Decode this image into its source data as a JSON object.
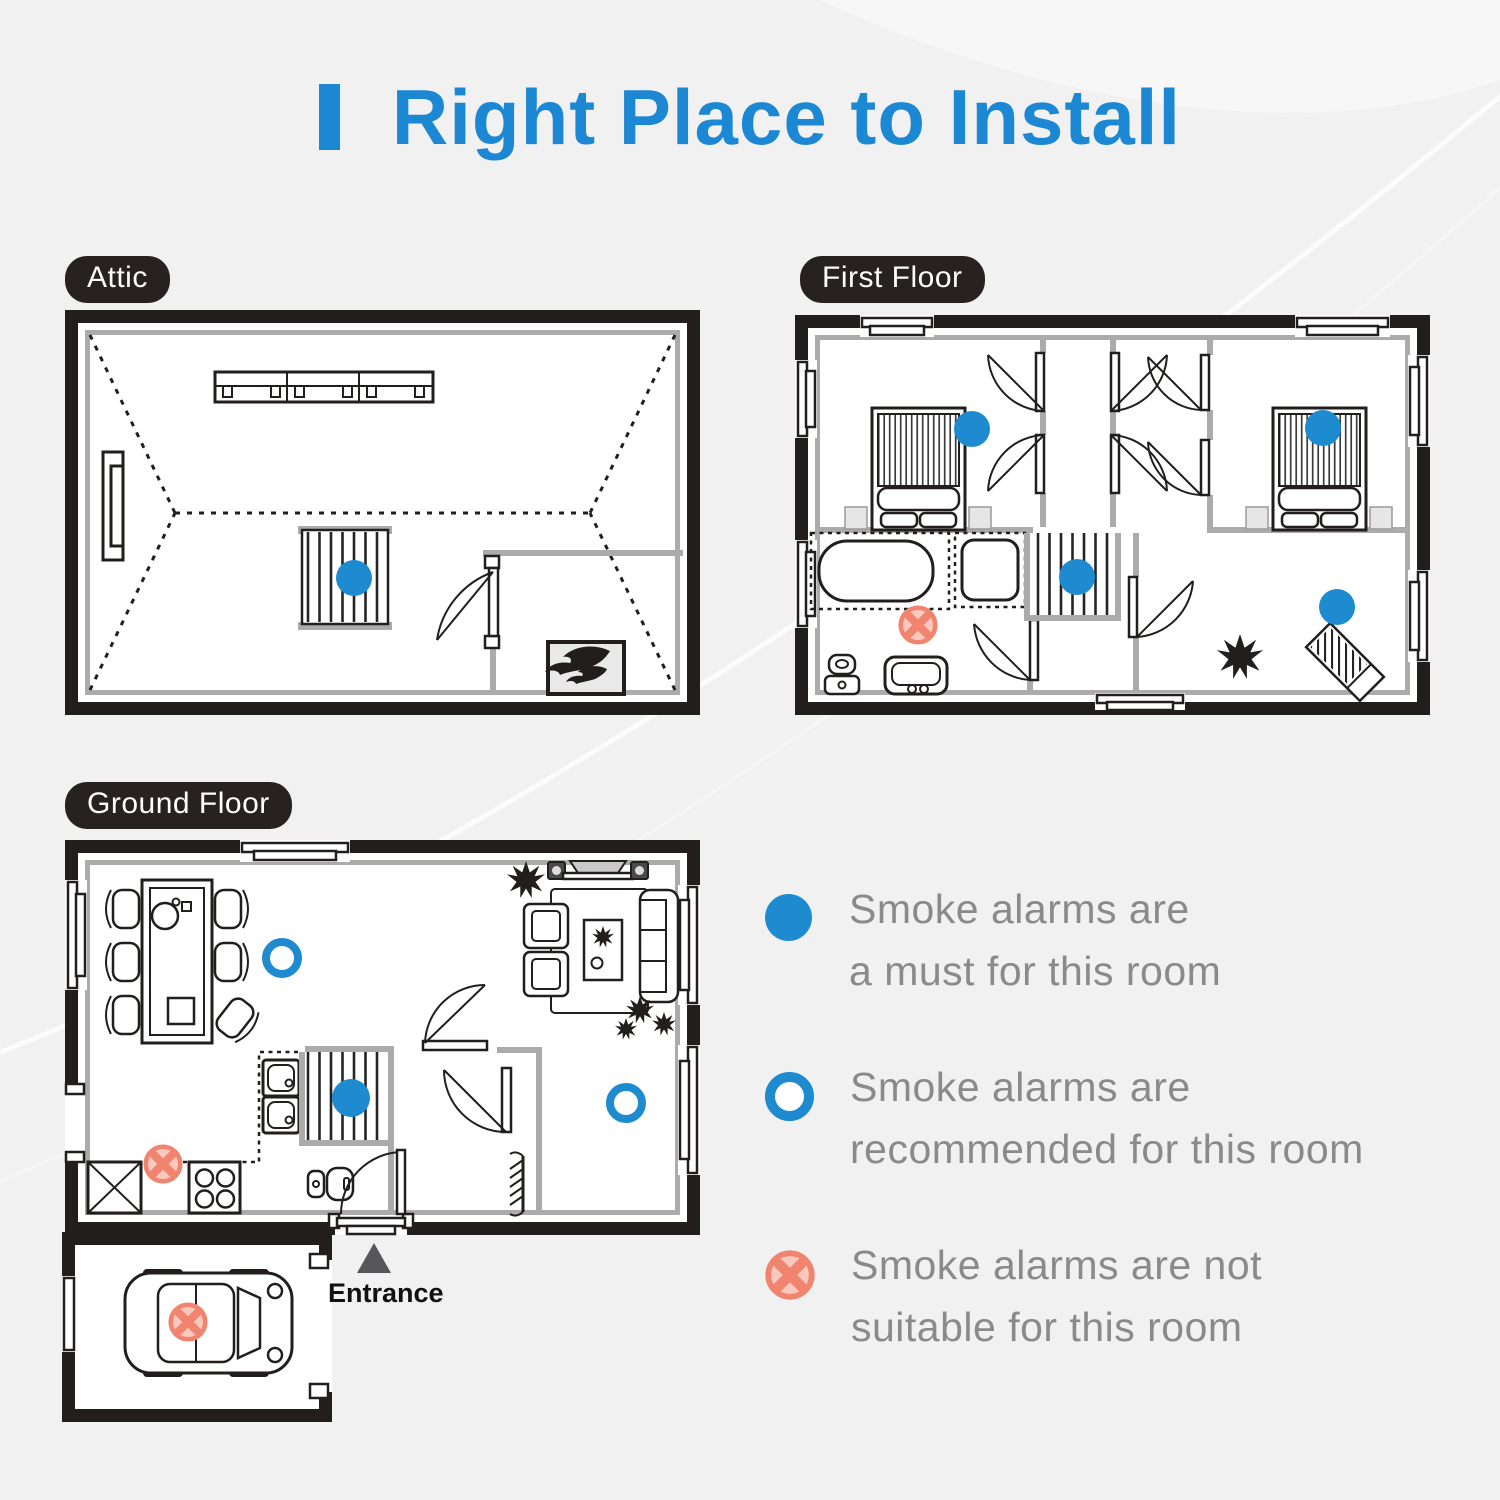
{
  "title": {
    "text": "Right Place to Install"
  },
  "floors": {
    "attic": {
      "label": "Attic"
    },
    "first": {
      "label": "First Floor"
    },
    "ground": {
      "label": "Ground Floor"
    }
  },
  "entrance_label": "Entrance",
  "legend": {
    "items": [
      {
        "type": "must",
        "lines": [
          "Smoke alarms are",
          "a must for this room"
        ]
      },
      {
        "type": "recommended",
        "lines": [
          "Smoke alarms are",
          "recommended for this room"
        ]
      },
      {
        "type": "not-suitable",
        "lines": [
          "Smoke alarms are not",
          "suitable for this room"
        ]
      }
    ]
  },
  "markers": [
    {
      "floor": "Attic",
      "type": "must",
      "location": "stairs"
    },
    {
      "floor": "First Floor",
      "type": "must",
      "location": "bedroom-left"
    },
    {
      "floor": "First Floor",
      "type": "must",
      "location": "bedroom-right"
    },
    {
      "floor": "First Floor",
      "type": "must",
      "location": "stairs"
    },
    {
      "floor": "First Floor",
      "type": "must",
      "location": "room-bottom-right"
    },
    {
      "floor": "First Floor",
      "type": "not-suitable",
      "location": "bathroom"
    },
    {
      "floor": "Ground Floor",
      "type": "recommended",
      "location": "dining-room"
    },
    {
      "floor": "Ground Floor",
      "type": "must",
      "location": "stairs"
    },
    {
      "floor": "Ground Floor",
      "type": "recommended",
      "location": "hallway"
    },
    {
      "floor": "Ground Floor",
      "type": "not-suitable",
      "location": "kitchen"
    },
    {
      "floor": "Garage",
      "type": "not-suitable",
      "location": "car"
    }
  ],
  "colors": {
    "accent_blue": "#1C87D2",
    "marker_blue": "#1E8BD1",
    "marker_red": "#F0846F",
    "marker_red_fill": "#FBC8BD",
    "ink": "#231E1E",
    "wall_gray": "#ABABAB",
    "label_bg": "#272121",
    "text_gray": "#8A8A8A",
    "panel_gray": "#E9E9E9"
  }
}
